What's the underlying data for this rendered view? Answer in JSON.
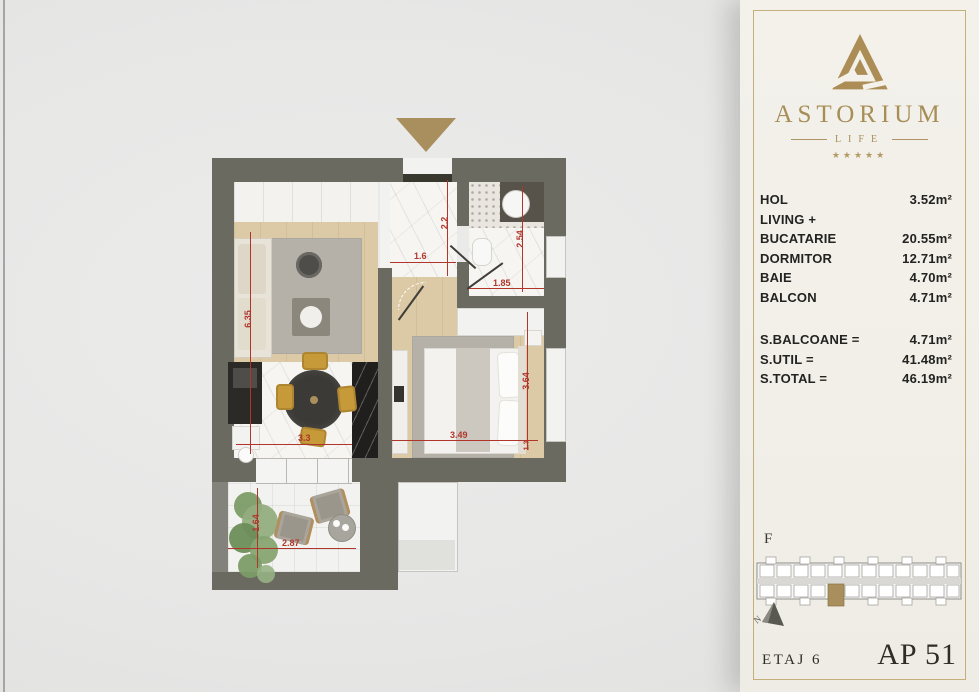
{
  "colors": {
    "accent_gold": "#a98f5d",
    "wall": "#6b6a60",
    "dimension_red": "#b0362b",
    "panel_bg": "#f1efe8",
    "panel_border": "#c4ae79"
  },
  "floor_plan": {
    "dimensions": {
      "living_depth": "6.35",
      "kitchen_width": "3.3",
      "hall_depth": "2.2",
      "hall_width": "1.6",
      "bath_depth": "2.54",
      "bath_width": "1.85",
      "bedroom_width": "3.49",
      "bedroom_depth": "3.64",
      "bedroom_nook": "1.3",
      "balcony_width": "2.87",
      "balcony_depth": "1.64"
    }
  },
  "sidebar": {
    "brand": {
      "name": "ASTORIUM",
      "tagline": "LIFE",
      "stars": "★★★★★"
    },
    "rooms": [
      {
        "label": "HOL",
        "area": "3.52m²"
      },
      {
        "label": "LIVING +",
        "area": ""
      },
      {
        "label": "BUCATARIE",
        "area": "20.55m²"
      },
      {
        "label": "DORMITOR",
        "area": "12.71m²"
      },
      {
        "label": "BAIE",
        "area": "4.70m²"
      },
      {
        "label": "BALCON",
        "area": "4.71m²"
      }
    ],
    "totals": [
      {
        "label": "S.BALCOANE =",
        "value": "4.71m²"
      },
      {
        "label": "S.UTIL =",
        "value": "41.48m²"
      },
      {
        "label": "S.TOTAL =",
        "value": "46.19m²"
      }
    ],
    "building": {
      "label": "F",
      "compass": "N"
    },
    "footer": {
      "floor": "ETAJ 6",
      "apartment": "AP 51"
    }
  }
}
